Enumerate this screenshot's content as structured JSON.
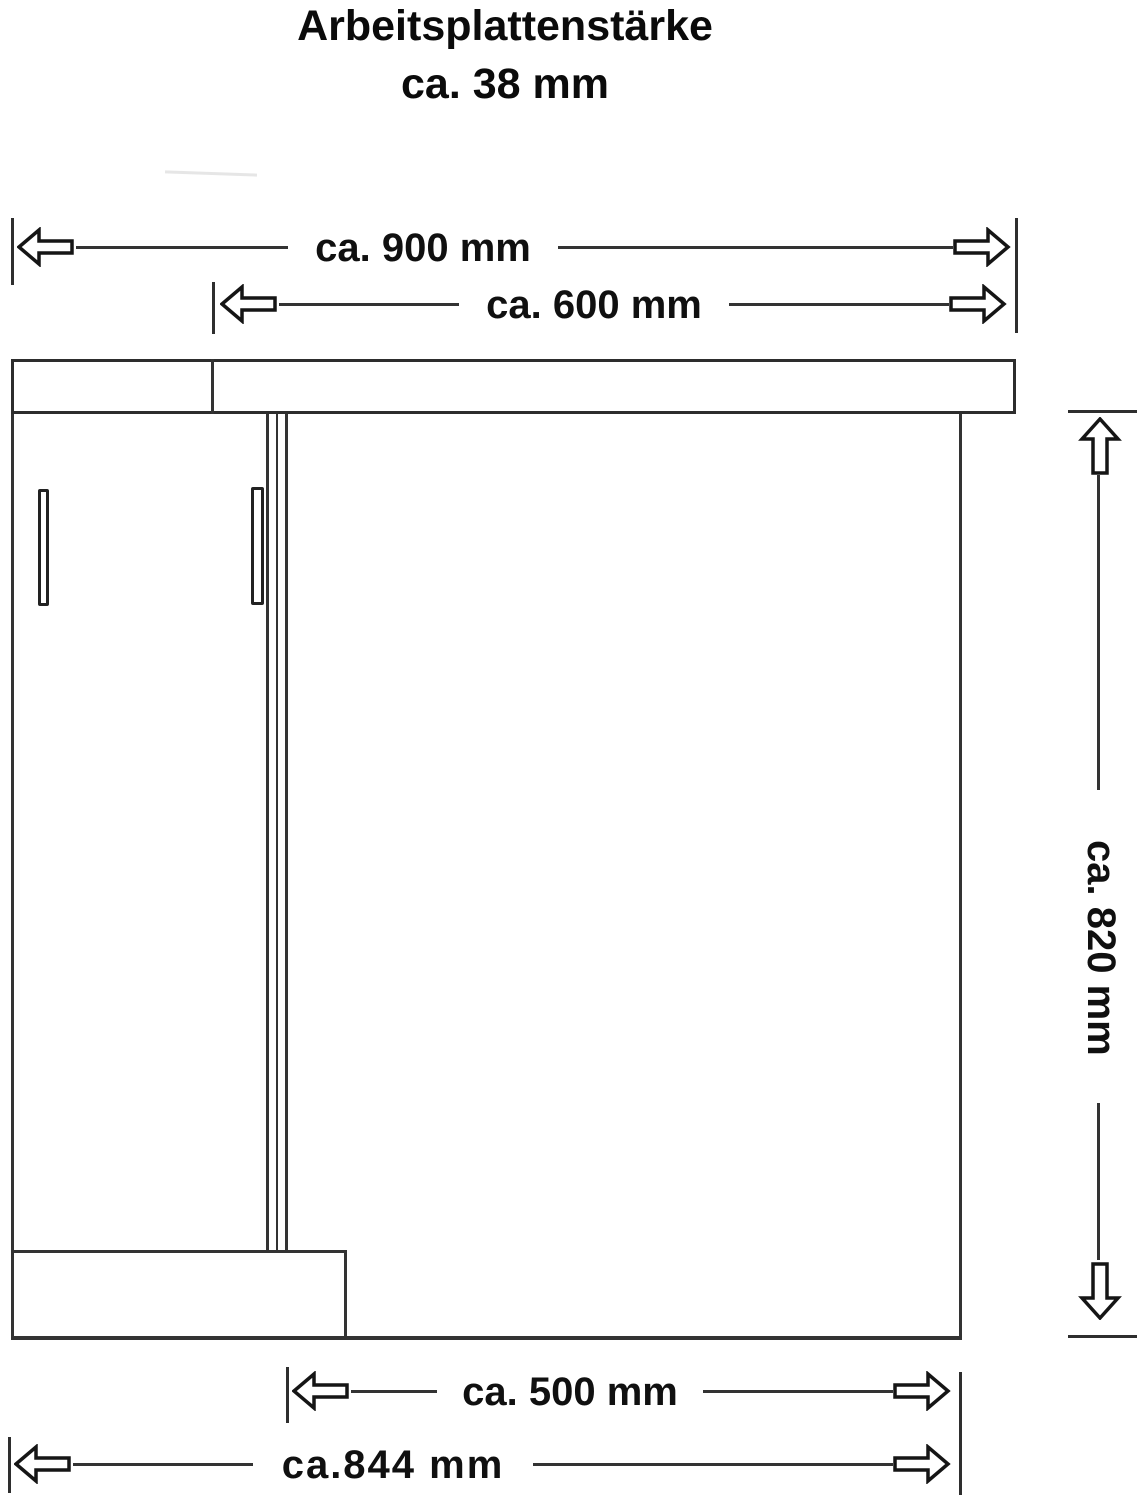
{
  "colors": {
    "background": "#ffffff",
    "line": "#333333",
    "arrow_outline": "#151515",
    "text": "#0f0f0f"
  },
  "title": {
    "line1": "Arbeitsplattenstärke",
    "line2": "ca. 38 mm"
  },
  "dimensions": {
    "worktop_total_width": "ca. 900 mm",
    "worktop_right_width": "ca. 600 mm",
    "cabinet_height": "ca. 820 mm",
    "front_inner_width": "ca. 500 mm",
    "base_total_width": "ca.844 mm"
  }
}
